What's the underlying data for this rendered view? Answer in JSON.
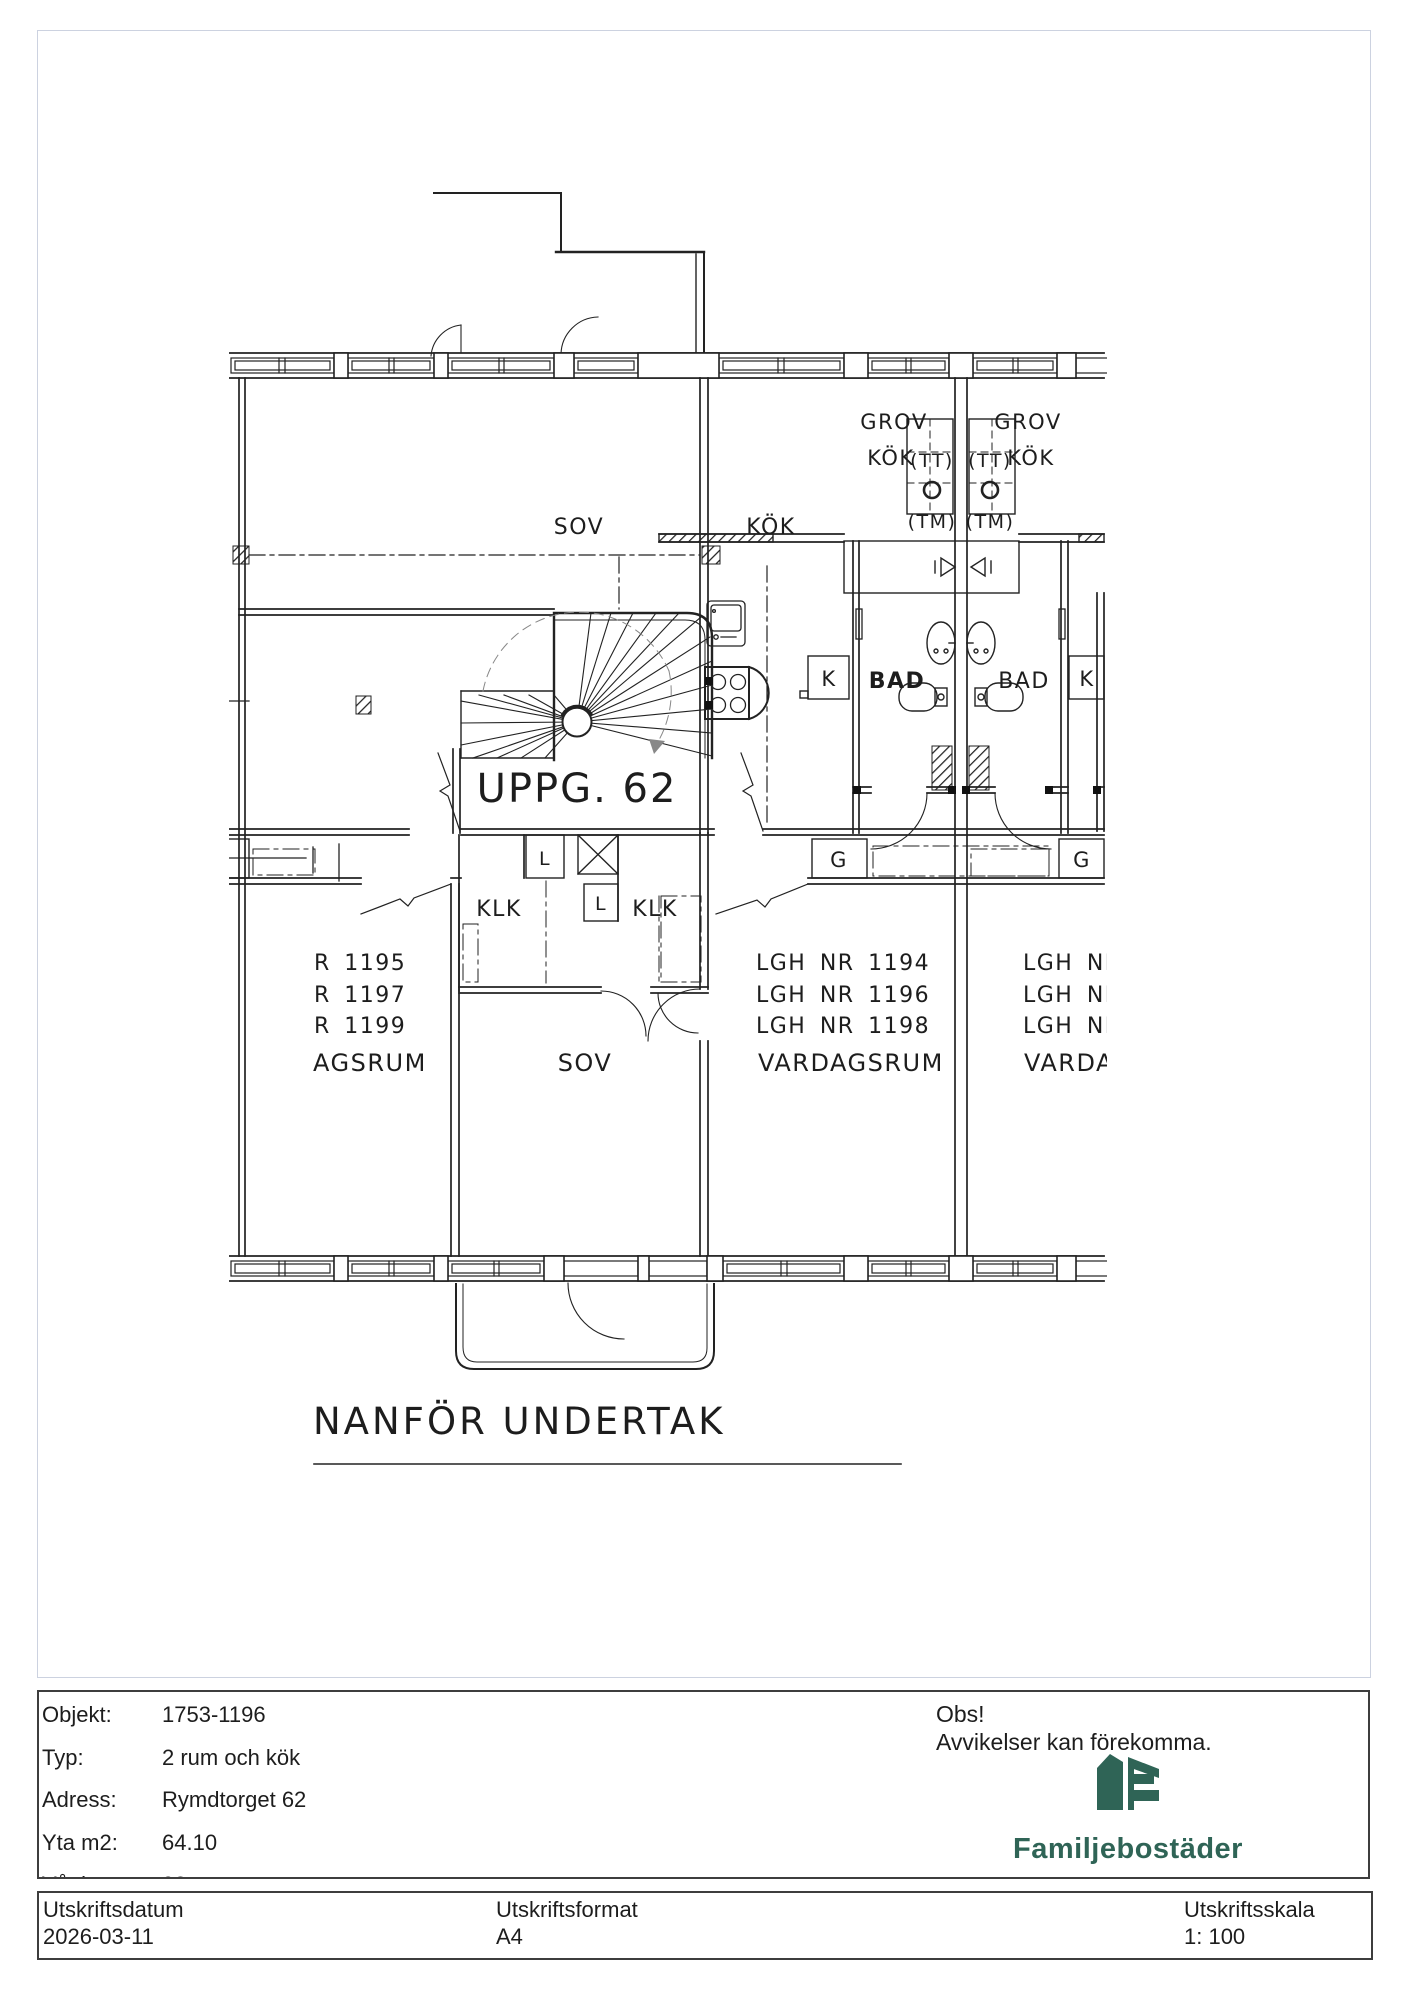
{
  "plan": {
    "labels": {
      "sov_top": "SOV",
      "kok_main": "KÖK",
      "grov_left_l1": "GROV",
      "grov_left_l2": "KÖK",
      "grov_right_l1": "GROV",
      "grov_right_l2": "KÖK",
      "tt_left": "(TT)",
      "tm_left": "(TM)",
      "tt_right": "(TT)",
      "tm_right": "(TM)",
      "uppg": "UPPG. 62",
      "k_left": "K",
      "k_right": "K",
      "bad_left": "BAD",
      "bad_right": "BAD",
      "l_upper": "L",
      "l_lower": "L",
      "g_left": "G",
      "g_right": "G",
      "klk_left": "KLK",
      "klk_right": "KLK",
      "lgh_left_1": "R 1195",
      "lgh_left_2": "R 1197",
      "lgh_left_3": "R 1199",
      "room_left": "AGSRUM",
      "lgh_mid_1": "LGH NR 1194",
      "lgh_mid_2": "LGH NR 1196",
      "lgh_mid_3": "LGH NR 1198",
      "room_mid": "VARDAGSRUM",
      "lgh_right_1": "LGH NR",
      "lgh_right_2": "LGH NR",
      "lgh_right_3": "LGH NR",
      "room_right": "VARDAG",
      "sov_lower": "SOV",
      "undertak_note": "NANFÖR UNDERTAK"
    }
  },
  "info": {
    "rows": [
      {
        "label": "Objekt:",
        "value": "1753-1196"
      },
      {
        "label": "Typ:",
        "value": "2 rum och kök"
      },
      {
        "label": "Adress:",
        "value": "Rymdtorget 62"
      },
      {
        "label": "Yta m2:",
        "value": "64.10"
      },
      {
        "label": "Våning:",
        "value": "02"
      }
    ]
  },
  "notice": {
    "title": "Obs!",
    "text": "Avvikelser kan förekomma."
  },
  "brand": {
    "name": "Familjebostäder"
  },
  "print": {
    "date_label": "Utskriftsdatum",
    "date": "2026-03-11",
    "format_label": "Utskriftsformat",
    "format": "A4",
    "scale_label": "Utskriftsskala",
    "scale": "1: 100"
  },
  "colors": {
    "brand_green": "#2f6456",
    "line": "#222222",
    "border_light": "#ccd2e0",
    "border_dark": "#3d3d3d"
  }
}
